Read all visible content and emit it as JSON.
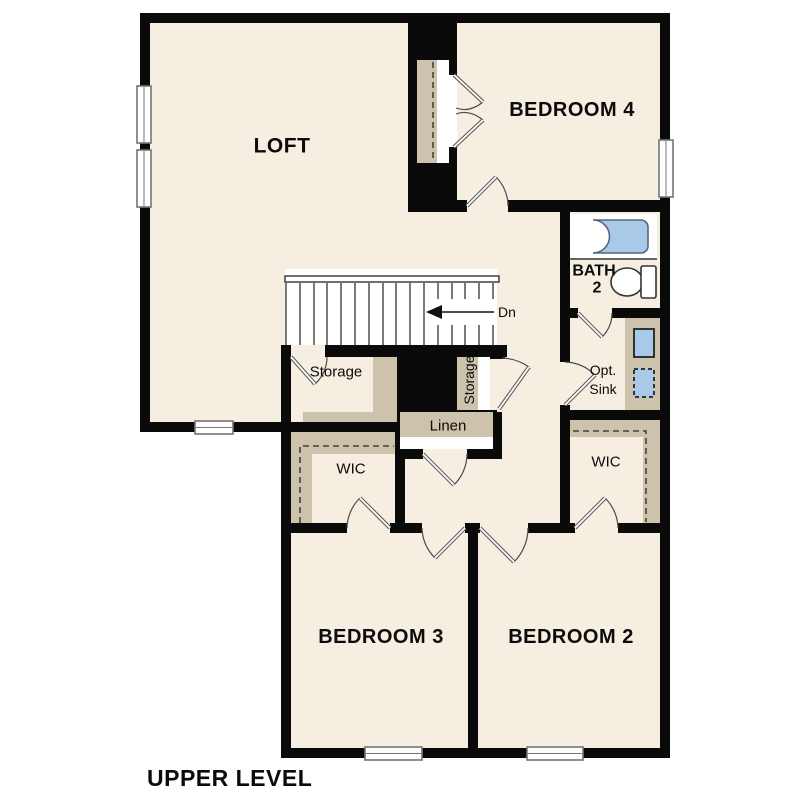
{
  "plan": {
    "title": "UPPER LEVEL",
    "labels": {
      "loft": "LOFT",
      "bedroom4": "BEDROOM 4",
      "bath": "BATH",
      "bath_number": "2",
      "stairs_direction": "Dn",
      "storage_room": "Storage",
      "storage_closet": "Storage",
      "linen": "Linen",
      "opt_sink_line1": "Opt.",
      "opt_sink_line2": "Sink",
      "wic_left": "WIC",
      "wic_right": "WIC",
      "bedroom3": "BEDROOM 3",
      "bedroom2": "BEDROOM 2"
    },
    "colors": {
      "background": "#ffffff",
      "floor": "#f6eee1",
      "wall": "#0a0a0a",
      "shelf_tan": "#cdc2ab",
      "fixture_blue": "#a9c9e9"
    }
  }
}
